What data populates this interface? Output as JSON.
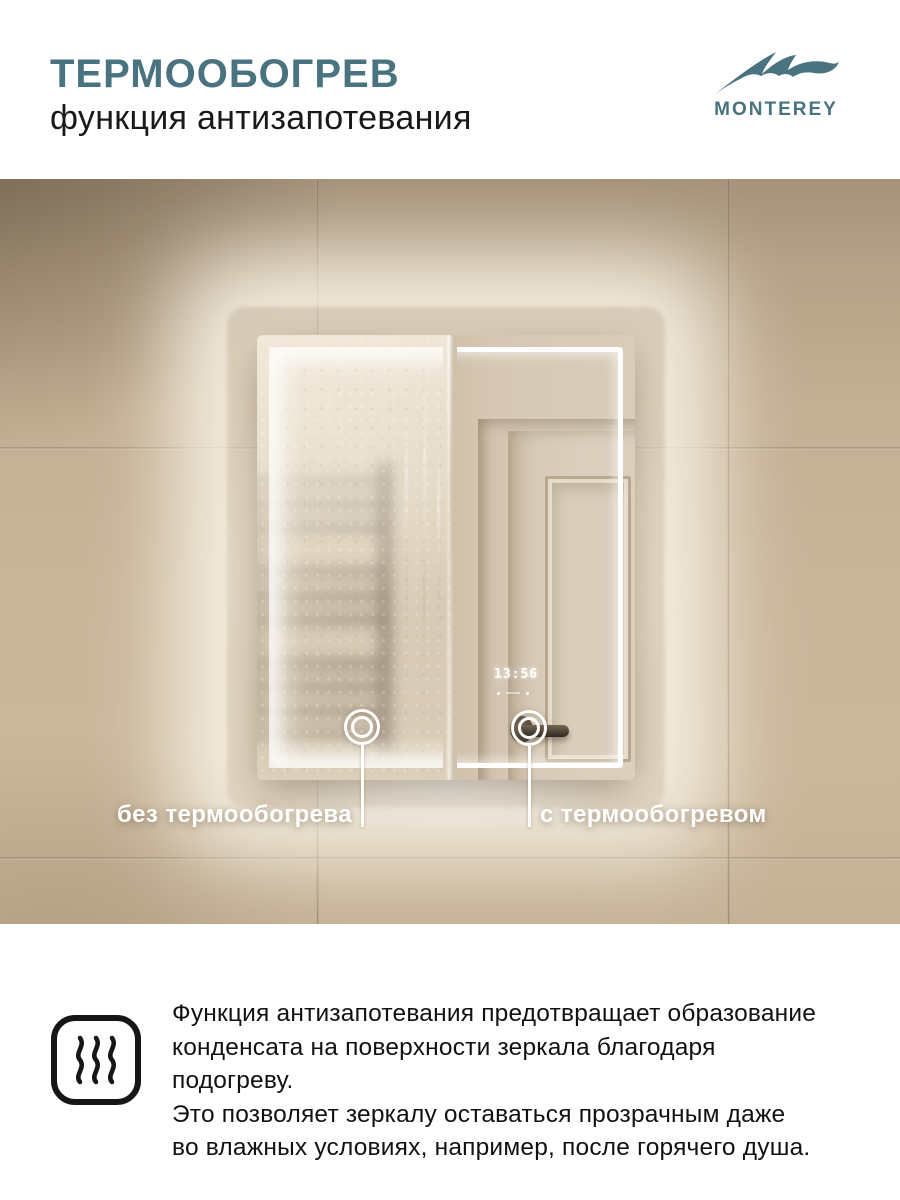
{
  "header": {
    "title": "ТЕРМООБОГРЕВ",
    "subtitle": "функция антизапотевания",
    "brand": "MONTEREY"
  },
  "photo": {
    "label_left": "без термообогрева",
    "label_right": "с термообогревом",
    "clock": "13:56"
  },
  "footer": {
    "description": "Функция антизапотевания предотвращает образование\nконденсата на поверхности зеркала благодаря подогреву.\nЭто позволяет зеркалу оставаться прозрачным даже\nво влажных условиях, например, после горячего душа."
  },
  "colors": {
    "accent": "#4a7380",
    "wall": "#c9b69a",
    "led": "#ffffff",
    "text_dark": "#121212"
  }
}
